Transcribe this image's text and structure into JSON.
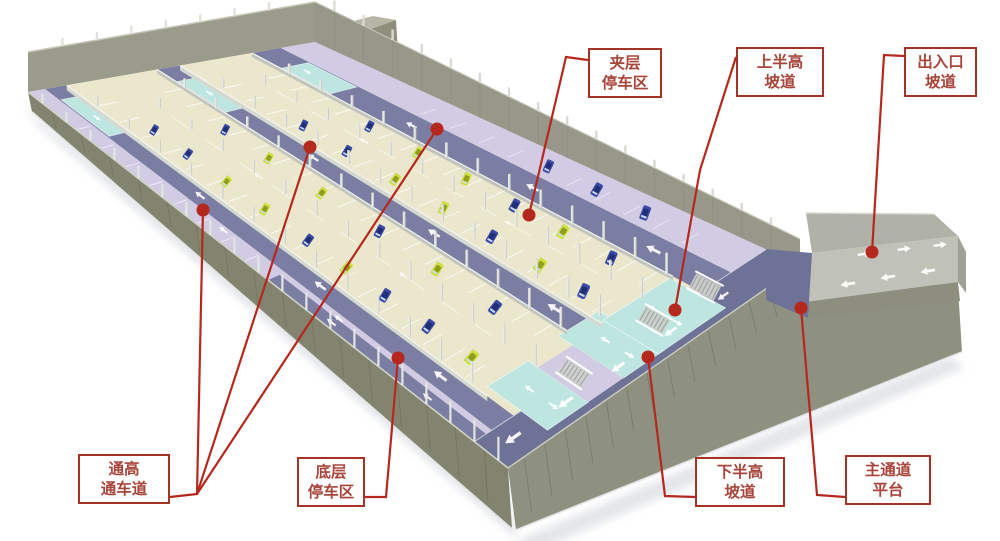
{
  "callouts": {
    "mezzanine_parking": {
      "line1": "夹层",
      "line2": "停车区"
    },
    "upper_half_ramp": {
      "line1": "上半高",
      "line2": "坡道"
    },
    "entrance_exit_ramp": {
      "line1": "出入口",
      "line2": "坡道"
    },
    "full_height_lane": {
      "line1": "通高",
      "line2": "通车道"
    },
    "ground_floor_parking": {
      "line1": "底层",
      "line2": "停车区"
    },
    "lower_half_ramp": {
      "line1": "下半高",
      "line2": "坡道"
    },
    "main_aisle_platform": {
      "line1": "主通道",
      "line2": "平台"
    }
  },
  "palette": {
    "callout_border": "#a63426",
    "callout_text": "#a8453a",
    "leader_line": "#b5281e",
    "mezzanine_deck": "#ebe7cd",
    "full_height_lane": "#7b7ea2",
    "ground_floor": "#d1cbe4",
    "ramp_surface": "#bde6e1",
    "main_aisle": "#6f7297",
    "wall_outer_left": "#82846f",
    "wall_outer_right": "#8e9080",
    "wall_inner": "#97988a",
    "entry_ramp_road": "#c0c2ba",
    "column": "#e7e9e3",
    "car_blue": "#3b4aa6",
    "car_yellow": "#cfe13c",
    "arrow": "#ffffff"
  }
}
